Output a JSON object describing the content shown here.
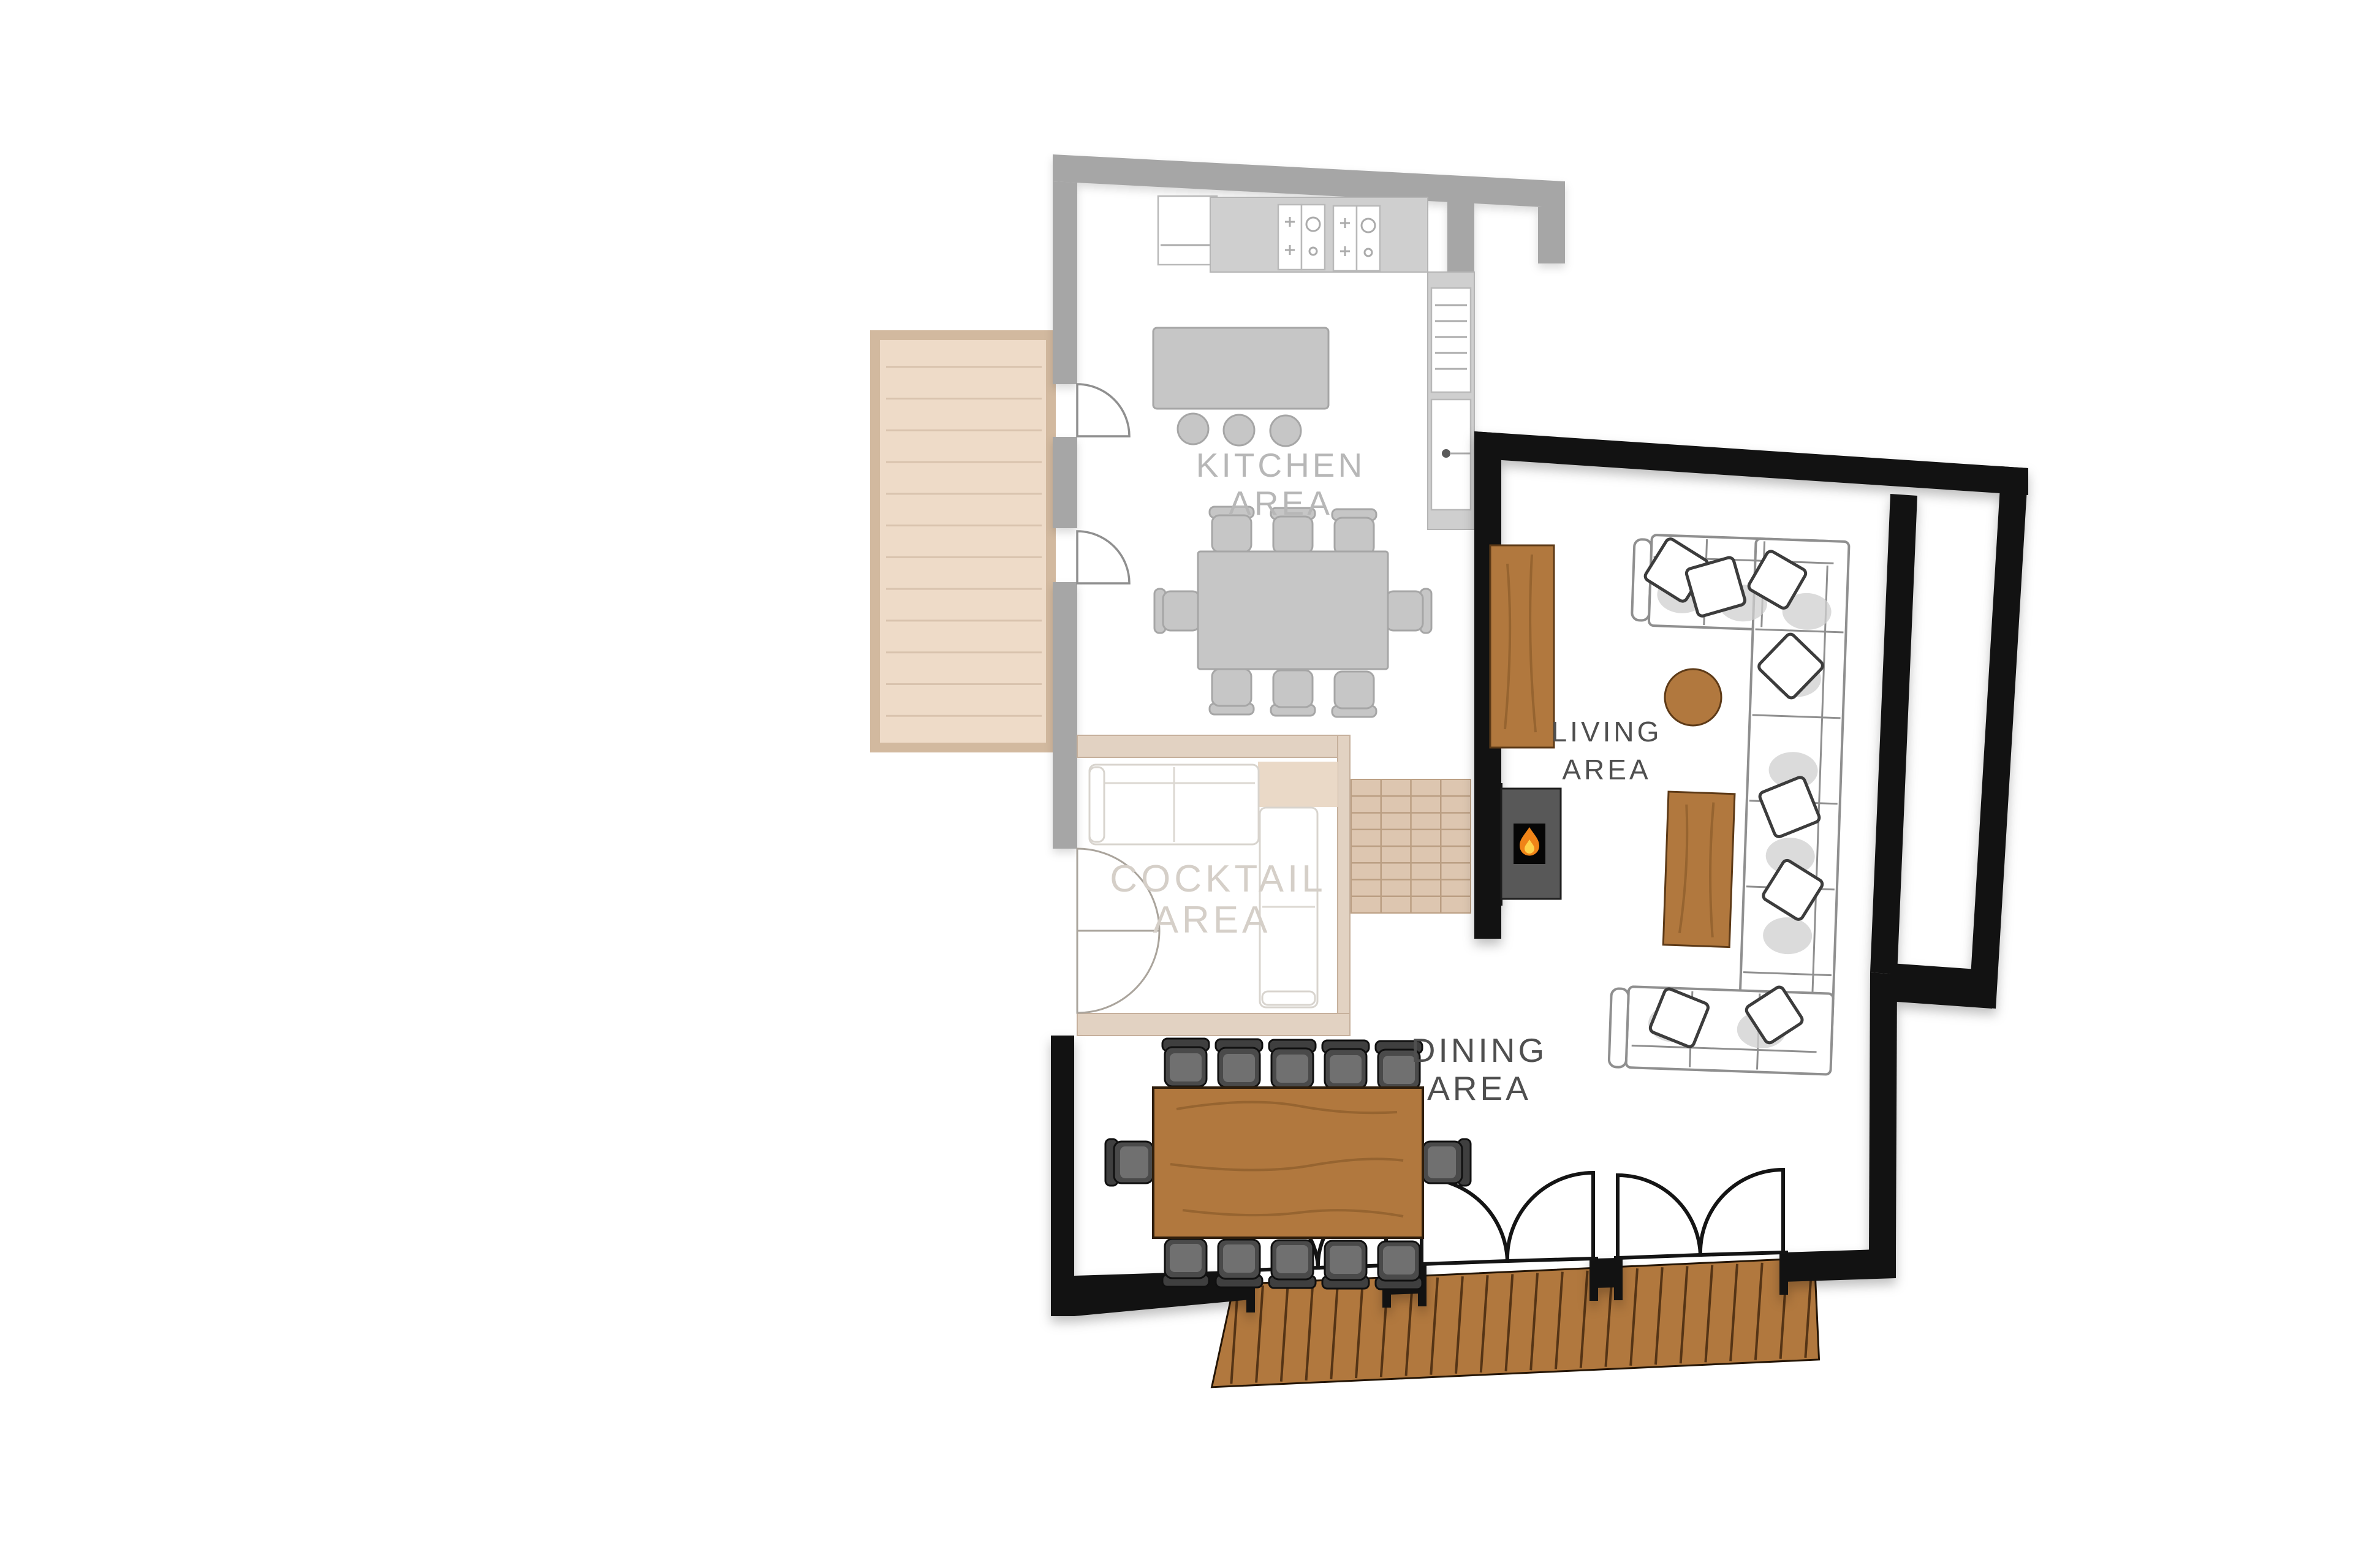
{
  "colors": {
    "wall_active": "#121212",
    "wall_faded": "#a6a6a6",
    "wall_cocktail": "#e2d2c2",
    "wood": "#b1783e",
    "deck_faded": "#eedbc8",
    "deck_faded_border": "#d2b99f",
    "stairs_fill": "#ddc6b0",
    "beige_block": "#ead9c7",
    "flame_orange": "#f08418",
    "flame_yellow": "#ffd24a",
    "text_faded": "#b7b7b7",
    "text_cocktail": "#d5cfc8",
    "text_active": "#4f4f4f"
  },
  "areas": {
    "kitchen": {
      "label": [
        "KITCHEN",
        "AREA"
      ],
      "state": "faded",
      "island_stools": 3,
      "table_chairs": 8
    },
    "cocktail": {
      "label": [
        "COCKTAIL",
        "AREA"
      ],
      "state": "faded"
    },
    "living": {
      "label": [
        "LIVING",
        "AREA"
      ],
      "state": "active",
      "sofa_pillows": 8,
      "sofa_cushions": 9
    },
    "dining": {
      "label": [
        "DINING",
        "AREA"
      ],
      "state": "active",
      "table_chairs": 12
    }
  },
  "features": {
    "left_deck_planks": 12,
    "bottom_deck_planks": 24,
    "stair_columns": 4,
    "stair_rows": 8,
    "bottom_double_doors": 3,
    "kitchen_side_doors": 2,
    "cocktail_double_doors": 1,
    "hob_units": 2,
    "fireplaces": 1
  }
}
